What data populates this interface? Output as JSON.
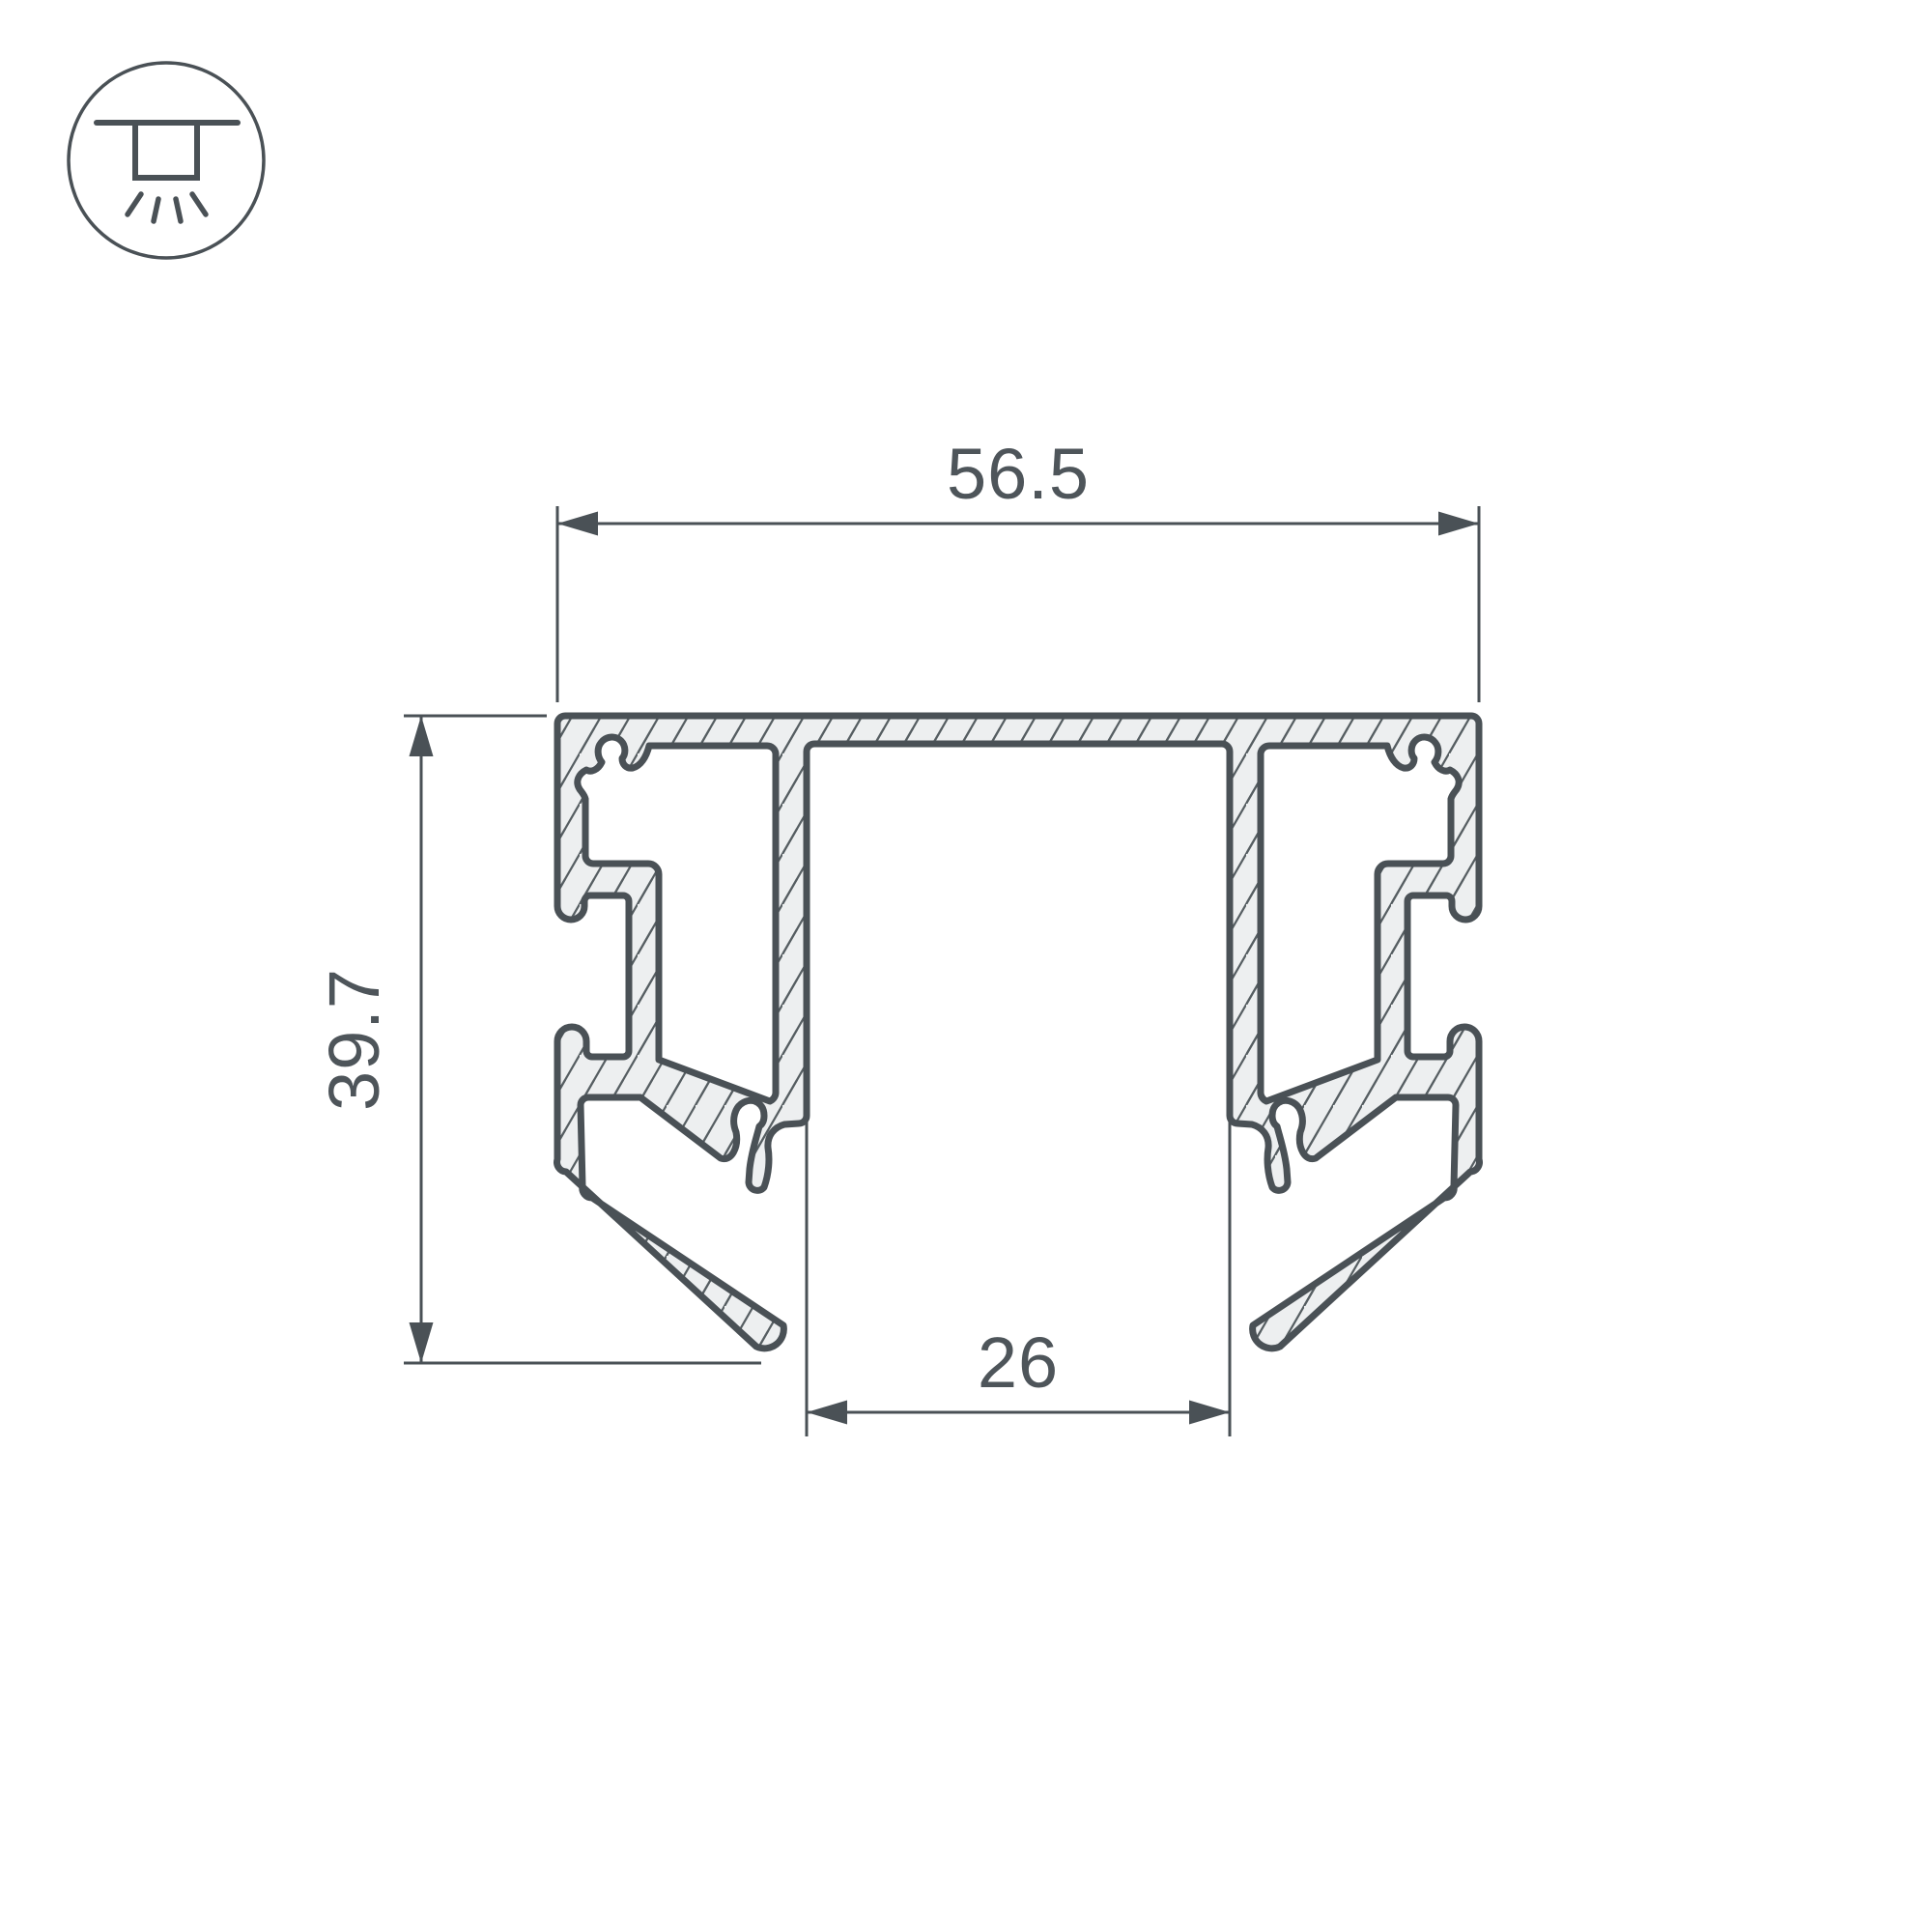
{
  "drawing": {
    "kind": "aluminium-led-profile-cross-section",
    "colors": {
      "outline": "#4a5156",
      "fill": "#edeff0",
      "hatch": "#565e62",
      "dimension": "#4a5156",
      "label": "#4e555a",
      "background": "#ffffff"
    },
    "dimensions": {
      "top_width": {
        "label": "56.5"
      },
      "left_height": {
        "label": "39.7"
      },
      "bottom_inner_width": {
        "label": "26"
      }
    }
  },
  "legend": {
    "icon": "ceiling-recessed-light-icon"
  }
}
